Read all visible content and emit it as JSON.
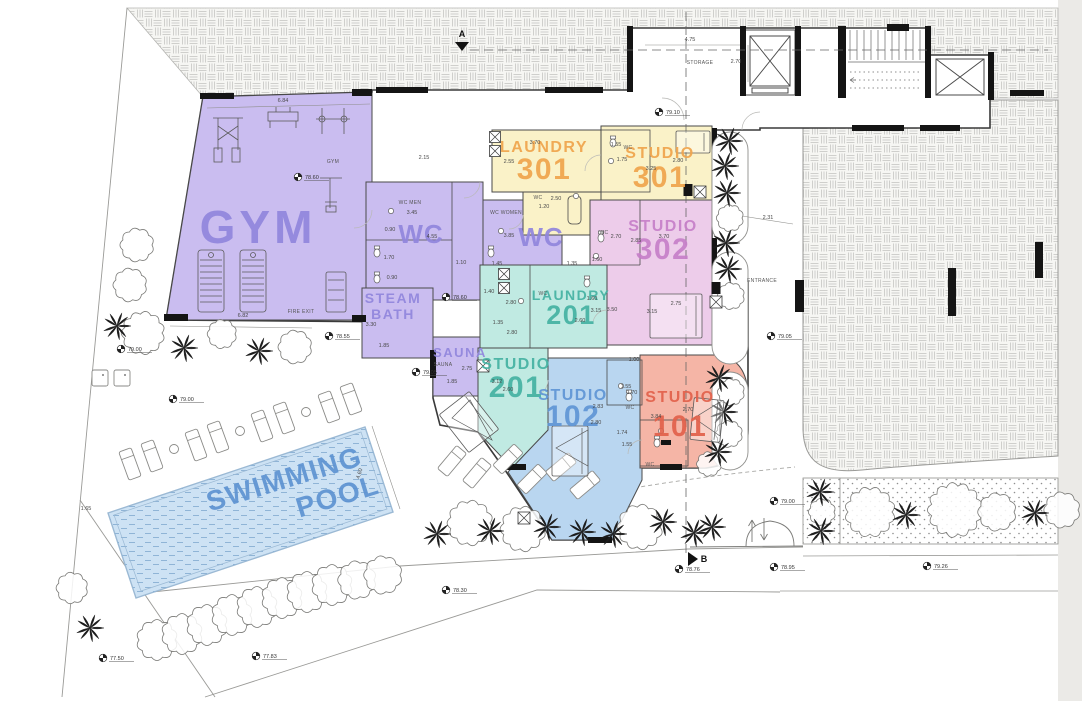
{
  "drawing_type": "architectural-floor-plan",
  "colors": {
    "purple": "#cabdf0",
    "purpleText": "#9186dd",
    "yellow": "#faf2c8",
    "orangeText": "#f0a44c",
    "pink": "#edccea",
    "pinkText": "#c77fc9",
    "teal": "#c0eae2",
    "tealText": "#45b2a2",
    "blue": "#b9d6f0",
    "blueText": "#5f95d5",
    "salmon": "#f5b5a6",
    "salmonText": "#e2614b",
    "pool": "#cde2f4",
    "poolText": "#5e93d2",
    "wall": "#141414",
    "line": "#8f8f8f",
    "dim": "#4a4a4a"
  },
  "room_labels": [
    {
      "t1": "GYM",
      "x": 258,
      "y": 243,
      "s1": 46,
      "c": "purpleText",
      "ls": 4
    },
    {
      "t1": "WC",
      "x": 421,
      "y": 243,
      "s1": 26,
      "c": "purpleText",
      "ls": 1
    },
    {
      "t1": "WC",
      "x": 541,
      "y": 246,
      "s1": 26,
      "c": "purpleText",
      "ls": 1
    },
    {
      "t1": "STEAM",
      "t2": "BATH",
      "x": 393,
      "y": 303,
      "s1": 14,
      "s2": 14,
      "lh": 16,
      "c": "purpleText"
    },
    {
      "t1": "SAUNA",
      "x": 460,
      "y": 357,
      "s1": 13,
      "c": "purpleText"
    },
    {
      "t1": "LAUNDRY",
      "t2": "301",
      "x": 544,
      "y": 152,
      "s1": 16,
      "s2": 30,
      "lh": 27,
      "c": "orangeText"
    },
    {
      "t1": "STUDIO",
      "t2": "301",
      "x": 660,
      "y": 158,
      "s1": 16,
      "s2": 30,
      "lh": 29,
      "c": "orangeText"
    },
    {
      "t1": "STUDIO",
      "t2": "302",
      "x": 663,
      "y": 231,
      "s1": 16,
      "s2": 30,
      "lh": 28,
      "c": "pinkText"
    },
    {
      "t1": "LAUNDRY",
      "t2": "201",
      "x": 571,
      "y": 300,
      "s1": 14,
      "s2": 27,
      "lh": 24,
      "c": "tealText"
    },
    {
      "t1": "STUDIO",
      "t2": "201",
      "x": 516,
      "y": 369,
      "s1": 16,
      "s2": 30,
      "lh": 28,
      "c": "tealText"
    },
    {
      "t1": "STUDIO",
      "t2": "102",
      "x": 573,
      "y": 400,
      "s1": 16,
      "s2": 30,
      "lh": 26,
      "c": "blueText"
    },
    {
      "t1": "STUDIO",
      "t2": "101",
      "x": 680,
      "y": 402,
      "s1": 16,
      "s2": 30,
      "lh": 34,
      "c": "salmonText"
    },
    {
      "t1": "SWIMMING",
      "t2": "POOL",
      "x": 287,
      "y": 488,
      "s1": 28,
      "s2": 28,
      "lh": 32,
      "dx2": 46,
      "rot": -17,
      "c": "poolText"
    }
  ],
  "small_labels": [
    {
      "t": "GYM",
      "x": 333,
      "y": 163
    },
    {
      "t": "WC MEN",
      "x": 410,
      "y": 204
    },
    {
      "t": "WC WOMEN",
      "x": 506,
      "y": 214
    },
    {
      "t": "STORAGE",
      "x": 700,
      "y": 64
    },
    {
      "t": "ENTRANCE",
      "x": 762,
      "y": 282
    },
    {
      "t": "FIRE EXIT",
      "x": 301,
      "y": 313
    },
    {
      "t": "SAUNA",
      "x": 443,
      "y": 366
    },
    {
      "t": "WC",
      "x": 538,
      "y": 199
    },
    {
      "t": "WC",
      "x": 604,
      "y": 234
    },
    {
      "t": "WC",
      "x": 543,
      "y": 295
    },
    {
      "t": "WC",
      "x": 628,
      "y": 149
    },
    {
      "t": "WC",
      "x": 630,
      "y": 409
    },
    {
      "t": "WC",
      "x": 650,
      "y": 466
    }
  ],
  "dimensions": [
    {
      "t": "6.84",
      "x": 283,
      "y": 102
    },
    {
      "t": "6.82",
      "x": 243,
      "y": 317
    },
    {
      "t": "2.15",
      "x": 424,
      "y": 159
    },
    {
      "t": "4.75",
      "x": 690,
      "y": 41
    },
    {
      "t": "2.70",
      "x": 736,
      "y": 63
    },
    {
      "t": "3.70",
      "x": 535,
      "y": 144
    },
    {
      "t": "2.55",
      "x": 509,
      "y": 163
    },
    {
      "t": "2.50",
      "x": 556,
      "y": 200
    },
    {
      "t": "1.20",
      "x": 544,
      "y": 208
    },
    {
      "t": "1.55",
      "x": 616,
      "y": 146
    },
    {
      "t": "1.75",
      "x": 622,
      "y": 161
    },
    {
      "t": "3.25",
      "x": 651,
      "y": 170
    },
    {
      "t": "2.80",
      "x": 678,
      "y": 162
    },
    {
      "t": "3.45",
      "x": 412,
      "y": 214
    },
    {
      "t": "0.90",
      "x": 390,
      "y": 231
    },
    {
      "t": "1.70",
      "x": 389,
      "y": 259
    },
    {
      "t": "0.90",
      "x": 392,
      "y": 279
    },
    {
      "t": "4.55",
      "x": 432,
      "y": 238
    },
    {
      "t": "1.10",
      "x": 461,
      "y": 264
    },
    {
      "t": "3.85",
      "x": 509,
      "y": 237
    },
    {
      "t": "1.45",
      "x": 497,
      "y": 265
    },
    {
      "t": "1.35",
      "x": 572,
      "y": 265
    },
    {
      "t": "3.30",
      "x": 371,
      "y": 326
    },
    {
      "t": "1.85",
      "x": 384,
      "y": 347
    },
    {
      "t": "2.75",
      "x": 467,
      "y": 370
    },
    {
      "t": "1.85",
      "x": 452,
      "y": 383
    },
    {
      "t": "2.70",
      "x": 616,
      "y": 238
    },
    {
      "t": "2.85",
      "x": 636,
      "y": 242
    },
    {
      "t": "3.70",
      "x": 664,
      "y": 238
    },
    {
      "t": "1.60",
      "x": 597,
      "y": 261
    },
    {
      "t": "1.60",
      "x": 592,
      "y": 300
    },
    {
      "t": "3.50",
      "x": 612,
      "y": 311
    },
    {
      "t": "3.15",
      "x": 652,
      "y": 313
    },
    {
      "t": "2.75",
      "x": 676,
      "y": 305
    },
    {
      "t": "3.15",
      "x": 596,
      "y": 312
    },
    {
      "t": "2.60",
      "x": 580,
      "y": 322
    },
    {
      "t": "1.40",
      "x": 489,
      "y": 293
    },
    {
      "t": "2.80",
      "x": 511,
      "y": 304
    },
    {
      "t": "1.35",
      "x": 498,
      "y": 324
    },
    {
      "t": "2.80",
      "x": 512,
      "y": 334
    },
    {
      "t": "1.00",
      "x": 634,
      "y": 361
    },
    {
      "t": "3.12",
      "x": 497,
      "y": 383
    },
    {
      "t": "2.60",
      "x": 508,
      "y": 391
    },
    {
      "t": "2.83",
      "x": 598,
      "y": 408
    },
    {
      "t": "2.80",
      "x": 596,
      "y": 424
    },
    {
      "t": "1.55",
      "x": 626,
      "y": 388
    },
    {
      "t": "1.70",
      "x": 632,
      "y": 394
    },
    {
      "t": "2.70",
      "x": 688,
      "y": 411
    },
    {
      "t": "3.84",
      "x": 656,
      "y": 418
    },
    {
      "t": "1.74",
      "x": 622,
      "y": 434
    },
    {
      "t": "1.55",
      "x": 627,
      "y": 446
    },
    {
      "t": "2.31",
      "x": 768,
      "y": 219
    },
    {
      "t": "1.65",
      "x": 86,
      "y": 510
    },
    {
      "t": "4.60",
      "x": 361,
      "y": 474,
      "r": -73
    }
  ],
  "levels": [
    {
      "v": "79.10",
      "x": 668,
      "y": 114
    },
    {
      "v": "78.60",
      "x": 307,
      "y": 179
    },
    {
      "v": "78.60",
      "x": 455,
      "y": 299
    },
    {
      "v": "78.55",
      "x": 338,
      "y": 338
    },
    {
      "v": "79.05",
      "x": 425,
      "y": 374
    },
    {
      "v": "79.00",
      "x": 130,
      "y": 351
    },
    {
      "v": "79.00",
      "x": 182,
      "y": 401
    },
    {
      "v": "79.05",
      "x": 780,
      "y": 338
    },
    {
      "v": "79.00",
      "x": 783,
      "y": 503
    },
    {
      "v": "78.76",
      "x": 688,
      "y": 571
    },
    {
      "v": "78.95",
      "x": 783,
      "y": 569
    },
    {
      "v": "78.30",
      "x": 455,
      "y": 592
    },
    {
      "v": "77.83",
      "x": 265,
      "y": 658
    },
    {
      "v": "77.50",
      "x": 112,
      "y": 660
    },
    {
      "v": "79.26",
      "x": 936,
      "y": 568
    }
  ],
  "sections": [
    {
      "label": "A",
      "x": 462,
      "y": 37,
      "dir": "down"
    },
    {
      "label": "B",
      "x": 704,
      "y": 562,
      "dir": "right"
    }
  ],
  "trees": {
    "palms": [
      [
        117,
        326
      ],
      [
        184,
        348
      ],
      [
        259,
        351
      ],
      [
        729,
        141
      ],
      [
        725,
        166
      ],
      [
        727,
        193
      ],
      [
        726,
        243
      ],
      [
        728,
        269
      ],
      [
        719,
        378
      ],
      [
        724,
        412
      ],
      [
        718,
        452
      ],
      [
        90,
        628
      ],
      [
        437,
        534
      ],
      [
        490,
        531
      ],
      [
        547,
        527
      ],
      [
        582,
        532
      ],
      [
        613,
        534
      ],
      [
        663,
        522
      ],
      [
        694,
        533
      ],
      [
        712,
        527
      ],
      [
        820,
        492
      ],
      [
        821,
        531
      ],
      [
        906,
        515
      ],
      [
        1035,
        513
      ]
    ],
    "bushes": [
      [
        137,
        245,
        15
      ],
      [
        130,
        285,
        15
      ],
      [
        143,
        333,
        19
      ],
      [
        222,
        334,
        13
      ],
      [
        295,
        347,
        15
      ],
      [
        730,
        218,
        12
      ],
      [
        731,
        296,
        12
      ],
      [
        731,
        392,
        12
      ],
      [
        729,
        434,
        12
      ],
      [
        709,
        464,
        11
      ],
      [
        72,
        588,
        14
      ],
      [
        157,
        640,
        18
      ],
      [
        182,
        634,
        18
      ],
      [
        207,
        625,
        18
      ],
      [
        232,
        615,
        18
      ],
      [
        257,
        607,
        18
      ],
      [
        282,
        598,
        18
      ],
      [
        307,
        592,
        18
      ],
      [
        332,
        585,
        18
      ],
      [
        357,
        580,
        17
      ],
      [
        383,
        575,
        17
      ],
      [
        470,
        523,
        20
      ],
      [
        523,
        529,
        20
      ],
      [
        640,
        527,
        20
      ],
      [
        822,
        512,
        12
      ],
      [
        870,
        512,
        22
      ],
      [
        955,
        510,
        24
      ],
      [
        997,
        512,
        17
      ],
      [
        1062,
        510,
        16
      ]
    ]
  },
  "loungers": {
    "items": [
      [
        130,
        464,
        -20
      ],
      [
        152,
        456,
        -20
      ],
      [
        196,
        445,
        -20
      ],
      [
        218,
        437,
        -20
      ],
      [
        262,
        426,
        -20
      ],
      [
        284,
        418,
        -20
      ],
      [
        329,
        407,
        -20
      ],
      [
        351,
        399,
        -20
      ],
      [
        452,
        461,
        40
      ],
      [
        477,
        473,
        40
      ],
      [
        508,
        459,
        45
      ],
      [
        532,
        479,
        45
      ],
      [
        561,
        467,
        50
      ],
      [
        585,
        485,
        50
      ]
    ],
    "tables": [
      [
        174,
        449
      ],
      [
        240,
        431
      ],
      [
        306,
        412
      ]
    ]
  },
  "planter_boxes": [
    [
      100,
      378
    ],
    [
      122,
      378
    ]
  ],
  "fixtures": {
    "toilets": [
      [
        377,
        253
      ],
      [
        377,
        279
      ],
      [
        491,
        253
      ],
      [
        613,
        143
      ],
      [
        601,
        238
      ],
      [
        587,
        283
      ],
      [
        629,
        397
      ],
      [
        657,
        443
      ]
    ],
    "sinks": [
      [
        391,
        211
      ],
      [
        501,
        231
      ],
      [
        611,
        161
      ],
      [
        596,
        256
      ],
      [
        521,
        301
      ],
      [
        621,
        386
      ],
      [
        661,
        431
      ],
      [
        576,
        196
      ]
    ],
    "washers": [
      [
        495,
        137
      ],
      [
        495,
        151
      ],
      [
        504,
        274
      ],
      [
        504,
        288
      ]
    ],
    "hobs": [
      [
        700,
        192
      ],
      [
        716,
        302
      ],
      [
        483,
        366
      ],
      [
        524,
        518
      ]
    ],
    "black_units": [
      [
        688,
        190
      ],
      [
        716,
        288
      ]
    ],
    "tub": [
      568,
      196,
      13,
      28
    ]
  },
  "beds": [
    {
      "x": 676,
      "y": 131,
      "w": 34,
      "h": 22,
      "rot": 0
    },
    {
      "x": 650,
      "y": 294,
      "w": 52,
      "h": 44,
      "rot": 0
    },
    {
      "x": 450,
      "y": 398,
      "w": 38,
      "h": 48,
      "rot": -38
    },
    {
      "x": 552,
      "y": 426,
      "w": 36,
      "h": 50,
      "rot": 0
    },
    {
      "x": 692,
      "y": 399,
      "w": 30,
      "h": 42,
      "rot": 6
    }
  ],
  "quilt_triangles": [
    [
      452,
      418,
      492,
      440,
      470,
      400
    ],
    [
      556,
      448,
      588,
      466,
      588,
      430
    ],
    [
      694,
      418,
      720,
      436,
      720,
      402
    ]
  ]
}
